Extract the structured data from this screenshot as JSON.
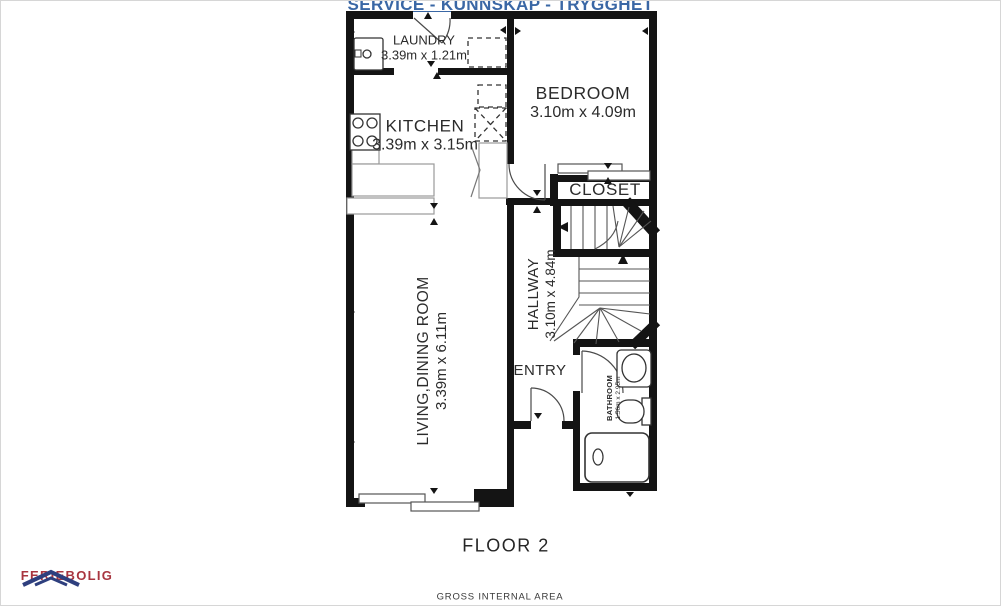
{
  "title": {
    "motto": "SERVICE - KUNNSKAP - TRYGGHET"
  },
  "rooms": {
    "laundry": {
      "name": "LAUNDRY",
      "dims": "3.39m x 1.21m"
    },
    "kitchen": {
      "name": "KITCHEN",
      "dims": "3.39m x 3.15m"
    },
    "bedroom": {
      "name": "BEDROOM",
      "dims": "3.10m x 4.09m"
    },
    "closet": {
      "name": "CLOSET"
    },
    "hallway": {
      "name": "HALLWAY",
      "dims": "3.10m x 4.84m"
    },
    "entry": {
      "name": "ENTRY"
    },
    "living_dining": {
      "name": "LIVING,DINING ROOM",
      "dims": "3.39m x 6.11m"
    },
    "bathroom": {
      "name": "BATHROOM",
      "dims": "1.56m x 2.95m"
    }
  },
  "floor_label": "FLOOR 2",
  "footer": {
    "area_label": "GROSS INTERNAL AREA",
    "brand": "FERIEBOLIG"
  },
  "fixtures": [
    "washing-machine",
    "stove",
    "kitchen-counter",
    "sliding-door",
    "staircase",
    "sink",
    "toilet",
    "shower-tub",
    "closet-sliding-door"
  ],
  "colors": {
    "motto_blue": "#3a67a5",
    "brand_red": "#a8353f",
    "wall_black": "#141414"
  }
}
